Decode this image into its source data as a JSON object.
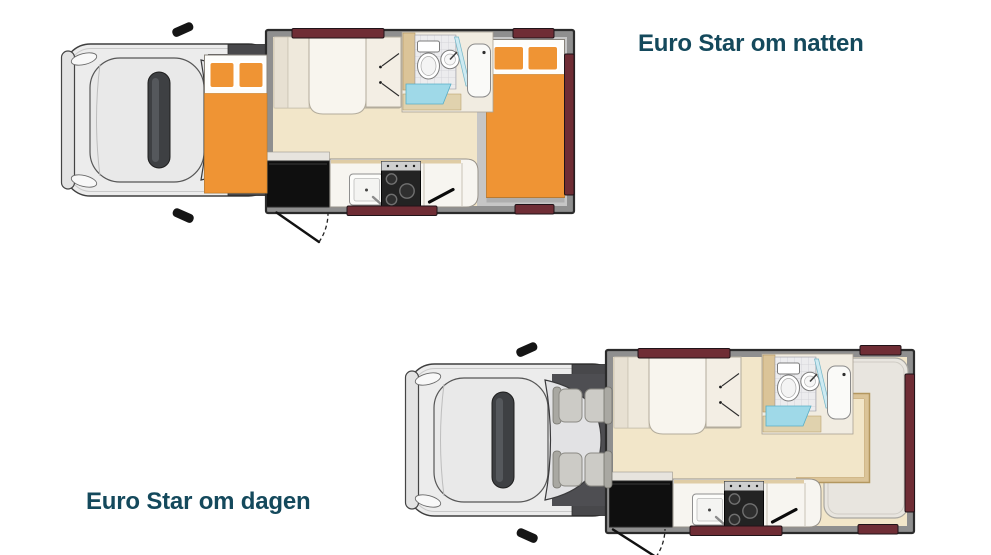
{
  "colors": {
    "background": "#ffffff",
    "title_text": "#14495c",
    "bedding_orange": "#ef9434",
    "floor_cream": "#f2e6c9",
    "trim_tan": "#dbc498",
    "trim_tan_dark": "#b3975f",
    "window_maroon": "#6f2d35",
    "wall_dark": "#2b2b2b",
    "wall_gray": "#8f8f8f",
    "vehicle_body": "#ececec",
    "vehicle_outline": "#3f3f3f",
    "windshield": "#e2e2e4",
    "cab_floor": "#4e4e52",
    "seat_gray": "#cccbc6",
    "rear_floor_gray": "#c6c6c6",
    "lounge_gray": "#e8e5df",
    "fridge_black": "#0f0f0f",
    "stove_black": "#232323",
    "fixture_white": "#fbfbfb",
    "bed_white": "#fdfdfb",
    "glass_aqua": "#9fd9e8",
    "tile_gray": "#ececee"
  },
  "plans": [
    {
      "id": "night",
      "title": "Euro Star om natten",
      "layout": [
        "over-cab double bed",
        "front double bed",
        "wardrobe",
        "bathroom: toilet, washbasin, shower",
        "kitchen: sink, 3-burner stove, fridge",
        "rear double bed",
        "entry door with swing"
      ]
    },
    {
      "id": "day",
      "title": "Euro Star om dagen",
      "layout": [
        "cab with 4 seats",
        "front sofa bed",
        "wardrobe",
        "bathroom: toilet, washbasin, shower",
        "kitchen: sink, 3-burner stove, fridge",
        "rear U-lounge with table",
        "entry door with swing"
      ]
    }
  ]
}
